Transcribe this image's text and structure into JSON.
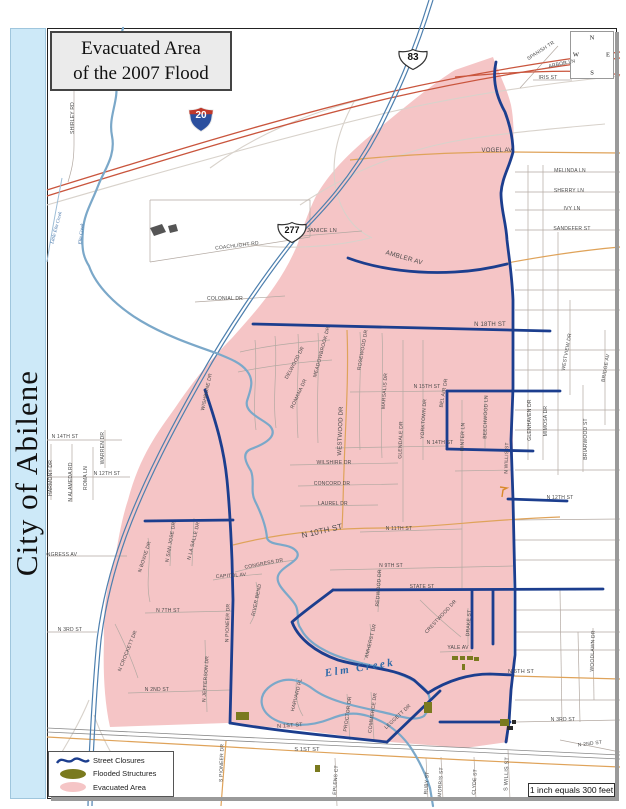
{
  "title": {
    "line1": "Evacuated Area",
    "line2": "of the 2007 Flood"
  },
  "sidebar": {
    "text": "City of Abilene"
  },
  "compass": {
    "n": "N",
    "e": "E",
    "s": "S",
    "w": "W"
  },
  "scale": {
    "text": "1 inch equals 300 feet"
  },
  "shields": [
    {
      "type": "interstate",
      "number": "20"
    },
    {
      "type": "us-route",
      "number": "83"
    },
    {
      "type": "us-route",
      "number": "277"
    }
  ],
  "legend": {
    "items": [
      {
        "label": "Street Closures",
        "color": "#1c3e8e"
      },
      {
        "label": "Flooded Structures",
        "color": "#7a7a1e"
      },
      {
        "label": "Evacuated Area",
        "color": "#f5c5c6"
      }
    ]
  },
  "colors": {
    "evacuated_area": "#f5c5c6",
    "street_closure": "#1c3e8e",
    "flooded_structure": "#7a7a1e",
    "creek": "#7ba8c9",
    "major_road": "#dfa35a",
    "freeway": "#4d7fae",
    "interstate": "#c9553d",
    "sidebar": "#cde9f8"
  },
  "map": {
    "creek_labels": [
      {
        "t": "Little Elm Creek",
        "x": 57,
        "y": 228,
        "r": -75,
        "s": 5
      },
      {
        "t": "Elm Creek",
        "x": 82,
        "y": 234,
        "r": -83,
        "s": 5
      },
      {
        "t": "Elm Creek",
        "x": 360,
        "y": 668,
        "r": -9,
        "s": 11,
        "big": true
      }
    ],
    "street_labels": [
      {
        "t": "SHIRLEY RD",
        "x": 73,
        "y": 118,
        "r": -90
      },
      {
        "t": "SPANISH TR",
        "x": 541,
        "y": 51,
        "r": -33
      },
      {
        "t": "ARBOR LN",
        "x": 562,
        "y": 64,
        "r": -12
      },
      {
        "t": "IRIS ST",
        "x": 548,
        "y": 78,
        "r": 0
      },
      {
        "t": "VOGEL AV",
        "x": 497,
        "y": 151,
        "r": 0,
        "s": 6
      },
      {
        "t": "MELINDA LN",
        "x": 570,
        "y": 171,
        "r": 0
      },
      {
        "t": "SHERRY LN",
        "x": 569,
        "y": 191,
        "r": 0
      },
      {
        "t": "IVY LN",
        "x": 572,
        "y": 209,
        "r": 0
      },
      {
        "t": "SANDEFER ST",
        "x": 572,
        "y": 229,
        "r": 0
      },
      {
        "t": "COACHLIGHT RD",
        "x": 237,
        "y": 246,
        "r": -7
      },
      {
        "t": "JANICE LN",
        "x": 322,
        "y": 231,
        "r": 0,
        "s": 5.5
      },
      {
        "t": "AMBLER AV",
        "x": 404,
        "y": 258,
        "r": 16,
        "s": 6.5
      },
      {
        "t": "COLONIAL DR",
        "x": 225,
        "y": 299,
        "r": 0
      },
      {
        "t": "N 18TH ST",
        "x": 490,
        "y": 325,
        "r": 0,
        "s": 6
      },
      {
        "t": "WISHBONE DR",
        "x": 207,
        "y": 392,
        "r": -78
      },
      {
        "t": "DELWOOD DR",
        "x": 295,
        "y": 363,
        "r": -62
      },
      {
        "t": "MEADOWBROOK DR",
        "x": 322,
        "y": 352,
        "r": -75
      },
      {
        "t": "ROMANA DR",
        "x": 299,
        "y": 394,
        "r": -65
      },
      {
        "t": "ROSEWOOD DR",
        "x": 363,
        "y": 350,
        "r": -80
      },
      {
        "t": "MARSALIS DR",
        "x": 385,
        "y": 391,
        "r": -86
      },
      {
        "t": "WESTWOOD DR",
        "x": 341,
        "y": 431,
        "r": -88,
        "s": 6
      },
      {
        "t": "N 15TH ST",
        "x": 427,
        "y": 387,
        "r": 0
      },
      {
        "t": "BEL AIR DR",
        "x": 444,
        "y": 393,
        "r": -80
      },
      {
        "t": "YORKTOWN DR",
        "x": 424,
        "y": 419,
        "r": -86
      },
      {
        "t": "GLENDALE DR",
        "x": 401,
        "y": 440,
        "r": -88
      },
      {
        "t": "BEECHWOOD LN",
        "x": 486,
        "y": 417,
        "r": -88
      },
      {
        "t": "MINTER LN",
        "x": 463,
        "y": 437,
        "r": -88
      },
      {
        "t": "N 14TH ST",
        "x": 440,
        "y": 443,
        "r": 0
      },
      {
        "t": "N 14TH ST",
        "x": 65,
        "y": 437,
        "r": 0
      },
      {
        "t": "HARMONY DR",
        "x": 51,
        "y": 478,
        "r": -90
      },
      {
        "t": "N ALAMEDA RD",
        "x": 71,
        "y": 482,
        "r": -90
      },
      {
        "t": "ROMA LN",
        "x": 86,
        "y": 478,
        "r": -90
      },
      {
        "t": "WARREN DR",
        "x": 103,
        "y": 448,
        "r": -90
      },
      {
        "t": "N 12TH ST",
        "x": 107,
        "y": 474,
        "r": 0
      },
      {
        "t": "N 12TH ST",
        "x": 560,
        "y": 498,
        "r": 0
      },
      {
        "t": "N WILLIS ST",
        "x": 507,
        "y": 458,
        "r": -88
      },
      {
        "t": "GLENHAVEN DR",
        "x": 530,
        "y": 420,
        "r": -90
      },
      {
        "t": "MIMOSA DR",
        "x": 546,
        "y": 421,
        "r": -90
      },
      {
        "t": "WESTVIEW DR",
        "x": 567,
        "y": 352,
        "r": -80
      },
      {
        "t": "BRIDGE AV",
        "x": 606,
        "y": 368,
        "r": -80
      },
      {
        "t": "BRIARWOOD ST",
        "x": 586,
        "y": 439,
        "r": -90
      },
      {
        "t": "WILSHIRE DR",
        "x": 334,
        "y": 463,
        "r": 0
      },
      {
        "t": "CONCORD DR",
        "x": 332,
        "y": 484,
        "r": 0
      },
      {
        "t": "LAUREL DR",
        "x": 333,
        "y": 504,
        "r": 0
      },
      {
        "t": "N 11TH ST",
        "x": 399,
        "y": 529,
        "r": 0
      },
      {
        "t": "N 10TH ST",
        "x": 322,
        "y": 531,
        "r": -13,
        "s": 8
      },
      {
        "t": "N 9TH ST",
        "x": 391,
        "y": 566,
        "r": 0
      },
      {
        "t": "CONGRESS AV",
        "x": 58,
        "y": 555,
        "r": 0
      },
      {
        "t": "N BOWIE DR",
        "x": 145,
        "y": 557,
        "r": -72
      },
      {
        "t": "N SAN JOSE DR",
        "x": 171,
        "y": 542,
        "r": -80
      },
      {
        "t": "N LA SALLE DR",
        "x": 194,
        "y": 541,
        "r": -76
      },
      {
        "t": "CONGRESS DR",
        "x": 264,
        "y": 564,
        "r": -11
      },
      {
        "t": "CAPITOL AV",
        "x": 231,
        "y": 576,
        "r": -4
      },
      {
        "t": "RIVER BEND",
        "x": 257,
        "y": 600,
        "r": -78
      },
      {
        "t": "N 7TH ST",
        "x": 168,
        "y": 611,
        "r": 0
      },
      {
        "t": "N 3RD ST",
        "x": 70,
        "y": 630,
        "r": 0
      },
      {
        "t": "N CROCKETT DR",
        "x": 128,
        "y": 651,
        "r": -68
      },
      {
        "t": "N JEFFERSON DR",
        "x": 206,
        "y": 679,
        "r": -86
      },
      {
        "t": "N 2ND ST",
        "x": 157,
        "y": 690,
        "r": 0
      },
      {
        "t": "N PIONEER DR",
        "x": 228,
        "y": 623,
        "r": -88
      },
      {
        "t": "REDWOOD DR",
        "x": 379,
        "y": 588,
        "r": -86
      },
      {
        "t": "STATE ST",
        "x": 422,
        "y": 587,
        "r": 0
      },
      {
        "t": "CRESTWOOD DR",
        "x": 441,
        "y": 617,
        "r": -47
      },
      {
        "t": "DRAKE ST",
        "x": 469,
        "y": 623,
        "r": -86
      },
      {
        "t": "YALE AV",
        "x": 458,
        "y": 648,
        "r": 0
      },
      {
        "t": "AMHERST DR",
        "x": 371,
        "y": 641,
        "r": -76
      },
      {
        "t": "N 6TH ST",
        "x": 521,
        "y": 672,
        "r": 0,
        "s": 5.5
      },
      {
        "t": "WOODLAWN DR",
        "x": 593,
        "y": 651,
        "r": -88
      },
      {
        "t": "HARVARD PL",
        "x": 297,
        "y": 695,
        "r": -76
      },
      {
        "t": "PROCTOR DR",
        "x": 348,
        "y": 714,
        "r": -82
      },
      {
        "t": "COMMERCE DR",
        "x": 373,
        "y": 713,
        "r": -82
      },
      {
        "t": "LEGGETT DR",
        "x": 398,
        "y": 717,
        "r": -43
      },
      {
        "t": "N 1ST ST",
        "x": 290,
        "y": 726,
        "r": -4,
        "s": 5.5
      },
      {
        "t": "S 1ST ST",
        "x": 307,
        "y": 750,
        "r": 0,
        "s": 5.5
      },
      {
        "t": "S PIONEER DR",
        "x": 222,
        "y": 763,
        "r": -88
      },
      {
        "t": "EPLENS CT",
        "x": 336,
        "y": 780,
        "r": -86
      },
      {
        "t": "RUBY ST",
        "x": 427,
        "y": 783,
        "r": -86
      },
      {
        "t": "MORRIS ST",
        "x": 441,
        "y": 782,
        "r": -86
      },
      {
        "t": "CLYDE ST",
        "x": 475,
        "y": 782,
        "r": -86
      },
      {
        "t": "S WILLIS ST",
        "x": 507,
        "y": 774,
        "r": -88,
        "s": 5.5
      },
      {
        "t": "N 3RD ST",
        "x": 563,
        "y": 720,
        "r": 0
      },
      {
        "t": "N 2ND ST",
        "x": 590,
        "y": 744,
        "r": -7
      }
    ],
    "flooded_structures": [
      {
        "x": 452,
        "y": 656,
        "w": 6,
        "h": 4
      },
      {
        "x": 460,
        "y": 656,
        "w": 5,
        "h": 4
      },
      {
        "x": 467,
        "y": 656,
        "w": 6,
        "h": 4
      },
      {
        "x": 474,
        "y": 657,
        "w": 5,
        "h": 4
      },
      {
        "x": 462,
        "y": 664,
        "w": 3,
        "h": 6
      },
      {
        "x": 236,
        "y": 712,
        "w": 13,
        "h": 8
      },
      {
        "x": 424,
        "y": 702,
        "w": 8,
        "h": 11
      },
      {
        "x": 315,
        "y": 765,
        "w": 5,
        "h": 7
      },
      {
        "x": 500,
        "y": 719,
        "w": 9,
        "h": 7
      },
      {
        "x": 507,
        "y": 726,
        "w": 6,
        "h": 4,
        "cls": "mark-dark"
      },
      {
        "x": 512,
        "y": 720,
        "w": 4,
        "h": 4,
        "cls": "mark-dark"
      }
    ],
    "geometry": {
      "layers": [
        {
          "cls": "evac",
          "paths": [
            "M493,57 C498,72 507,88 511,105 C514,120 514,138 513,152 C508,168 501,178 501,193 C501,210 506,222 507,240 C509,258 512,275 513,300 L513,655 C514,680 512,700 508,742 L465,748 L390,742 L300,730 L227,723 L110,727 C104,700 103,668 104,640 C103,615 106,585 115,560 C118,540 122,518 128,500 C140,455 158,432 175,408 C195,378 215,355 232,338 C255,312 282,283 298,243 C305,222 310,208 316,196 C330,172 346,157 365,140 C395,115 432,84 455,70 Z"
          ]
        },
        {
          "cls": "minor-light",
          "paths": [
            "M47,205 C160,172 280,138 390,112 C460,96 540,84 620,76",
            "M210,168 C255,135 310,112 368,98",
            "M300,205 C345,175 395,153 450,142 C500,133 560,128 605,124",
            "M355,100 C338,130 330,160 336,190 C342,215 355,230 372,238",
            "M238,243 C280,250 330,248 370,238",
            "M89,700 C80,722 68,742 56,762",
            "M94,715 C102,738 112,755 120,768"
          ]
        },
        {
          "cls": "minor",
          "paths": [
            "M515,172 L620,172",
            "M515,192 L620,192",
            "M515,210 L620,210",
            "M515,230 L620,230",
            "M515,270 L620,270",
            "M515,290 L620,290",
            "M515,310 L620,310",
            "M515,350 L620,350",
            "M515,370 L620,370",
            "M515,410 L620,410",
            "M515,430 L620,430",
            "M515,470 L620,470",
            "M515,520 L620,519",
            "M515,540 L620,540",
            "M515,560 L620,560",
            "M515,610 L620,610",
            "M515,632 L620,632",
            "M515,650 L620,650",
            "M515,700 L620,700",
            "M515,722 L620,720",
            "M560,740 L620,752",
            "M528,165 L528,460",
            "M543,165 L543,460",
            "M558,232 L558,475",
            "M570,300 L570,395",
            "M583,385 L583,472",
            "M605,330 L605,425",
            "M593,628 L594,700",
            "M560,590 L562,722",
            "M578,632 L580,722",
            "M520,88 L558,46",
            "M536,70 L596,58",
            "M533,80 L572,80",
            "M47,440 L122,440",
            "M47,477 L130,477",
            "M51,444 L51,500",
            "M72,444 L72,502",
            "M93,447 L93,500",
            "M105,430 L105,468",
            "M47,556 L127,556",
            "M47,632 L97,632",
            "M74,60 L74,145 C74,162 71,172 68,182",
            "M150,262 L310,237",
            "M150,200 L310,200 L310,237",
            "M150,200 L150,262",
            "M195,302 L285,296",
            "M290,237 L362,231",
            "M255,340 C258,370 252,400 256,430",
            "M275,336 C278,366 272,396 276,428",
            "M298,334 C300,364 295,394 298,438",
            "M318,333 C320,363 316,390 318,443",
            "M360,332 C362,362 358,392 360,450",
            "M382,333 C384,373 380,412 382,458",
            "M403,340 L403,522",
            "M423,340 L423,460",
            "M462,400 L462,588",
            "M485,396 L485,448",
            "M240,352 C270,345 300,342 330,340",
            "M238,372 C268,366 300,362 332,360",
            "M290,465 L398,463",
            "M298,486 L398,484",
            "M300,506 L378,505",
            "M335,448 L447,446",
            "M350,392 L447,391",
            "M455,471 L513,470",
            "M360,532 L462,529",
            "M330,570 L513,566",
            "M145,613 L233,611",
            "M128,693 L230,690",
            "M235,572 C258,566 278,562 296,560",
            "M213,580 C235,576 250,575 262,574",
            "M440,652 L472,651",
            "M420,600 C436,616 450,628 461,637",
            "M468,608 L468,645",
            "M380,568 L378,612",
            "M370,624 C372,640 369,650 364,660",
            "M256,582 C260,600 256,614 250,624",
            "M148,538 C152,560 145,580 150,602",
            "M172,520 L170,566",
            "M194,518 L192,566",
            "M115,624 C125,644 132,660 138,678",
            "M205,640 L207,712",
            "M297,678 C294,695 298,708 303,716",
            "M347,694 L350,740",
            "M371,692 L374,740",
            "M335,758 L337,806",
            "M426,758 L428,800",
            "M441,757 L443,800",
            "M474,757 L476,800",
            "M508,750 L510,800"
          ]
        },
        {
          "cls": "tan",
          "paths": [
            "M350,160 C400,155 450,152 513,152 L620,153",
            "M507,263 C545,256 585,250 620,247",
            "M233,545 C280,533 330,528 385,528 C440,527 480,520 560,517",
            "M347,330 C349,380 345,430 344,470 C343,495 343,512 342,528",
            "M513,676 L620,679",
            "M47,737 L230,747 C330,753 450,760 620,767",
            "M226,741 L221,806"
          ]
        },
        {
          "cls": "rail",
          "paths": [
            "M47,728 L620,755",
            "M47,732 L620,759"
          ]
        },
        {
          "cls": "i20",
          "paths": [
            "M47,190 C160,155 280,118 390,92 C460,76 540,62 620,52",
            "M47,196 C160,161 280,124 390,98 C460,82 540,68 620,58",
            "M455,77 C510,72 560,70 600,72 C608,73 615,74 620,75"
          ]
        },
        {
          "cls": "fwy",
          "paths": [
            "M429,0 C412,55 396,90 375,132 C348,183 315,215 294,237 C262,277 226,330 198,380 C172,426 143,480 122,537 C112,565 102,600 97,640 C93,680 91,720 89,760 L88,806",
            "M433,0 C416,55 400,90 379,132 C352,183 319,215 298,237 C266,277 230,330 202,380 C176,426 147,480 126,537 C116,565 106,600 101,640 C97,680 95,720 93,760 L92,806"
          ]
        },
        {
          "cls": "creek-thin",
          "paths": [
            "M62,178 C57,205 51,235 47,262"
          ]
        },
        {
          "cls": "creek",
          "paths": [
            "M123,28 C118,48 113,62 116,82 C119,102 108,116 112,136 C116,156 104,170 98,186 C92,202 84,214 83,230 C81,250 84,258 89,266 C96,286 116,306 141,321 C166,336 196,346 216,353 C231,359 241,363 247,371 C255,381 250,391 247,401 C244,413 263,419 270,426 C276,433 273,441 251,449 C241,453 246,463 251,471 C255,481 250,491 255,501 C260,511 266,526 267,538 C270,547 290,542 297,552 C302,561 281,566 278,576 C275,586 291,596 296,606 C300,615 295,621 301,629 C306,639 316,646 326,651 C341,659 362,663 381,668 C401,674 420,681 428,693 C432,702 429,710 424,716 C415,722 400,716 382,712 C360,707 330,702 313,689 C295,676 280,678 268,688 C258,697 260,710 272,718 C286,727 310,727 330,719 C345,713 355,712 368,716 C388,722 402,735 411,748 C420,762 426,775 430,788 L433,806"
          ]
        },
        {
          "cls": "closure",
          "paths": [
            "M496,62 C492,80 496,96 505,112 C511,128 513,140 513,152 C509,168 502,178 501,193 C501,210 506,222 507,240 C509,258 512,275 513,300 L513,388 L511,440 L513,499 L515,590 L515,655 L511,690 L509,722 L506,742",
            "M348,258 C380,270 420,274 455,272 C478,271 495,267 507,264",
            "M253,324 L550,331",
            "M447,391 L560,391",
            "M447,391 L447,449",
            "M447,449 L533,451",
            "M508,499 L567,501",
            "M205,390 C217,425 224,450 227,480 C230,510 231,535 232,560 L233,600 L230,723",
            "M145,521 L233,520",
            "M333,590 L603,589",
            "M472,590 L472,648",
            "M493,590 L493,644",
            "M333,590 C316,603 302,613 292,622 C298,638 315,652 338,660 C365,668 395,668 414,680 L428,693",
            "M428,693 C448,680 470,674 490,674 L513,675",
            "M230,723 C260,728 300,733 340,737 L387,742",
            "M387,742 L440,691",
            "M440,722 L510,722"
          ]
        },
        {
          "cls": "bldg",
          "paths": [
            "M150,228 L162,224 L166,232 L154,236 Z",
            "M168,226 L176,224 L178,231 L170,233 Z"
          ]
        },
        {
          "cls": "mark-tan",
          "paths": [
            "M500,487 L507,488 L503,490 L502,497"
          ]
        }
      ]
    }
  }
}
